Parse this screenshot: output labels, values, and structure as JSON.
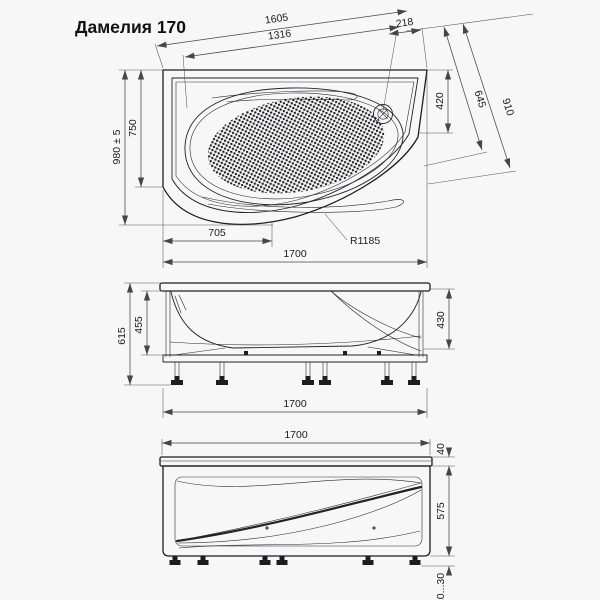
{
  "title": "Дамелия 170",
  "colors": {
    "background": "#f7f7f8",
    "line": "#1d1d1f",
    "dim_line": "#46464a",
    "text": "#1a1a1a"
  },
  "plan_view": {
    "dim_top_outer": "1605",
    "dim_top_inner": "1316",
    "dim_top_corner": "218",
    "dim_right_drain": "420",
    "dim_right_mid": "645",
    "dim_right_outer": "910",
    "dim_left_inner": "750",
    "dim_left_overall": "980 ± 5",
    "dim_bottom_inner": "705",
    "radius_label": "R1185",
    "dim_overall_length": "1700"
  },
  "side_view": {
    "dim_height_overall": "615",
    "dim_height_inner": "455",
    "dim_height_right": "430",
    "dim_length": "1700"
  },
  "front_view": {
    "dim_length": "1700",
    "dim_rim_height": "40",
    "dim_panel_height": "575",
    "dim_feet_range": "10...30"
  }
}
